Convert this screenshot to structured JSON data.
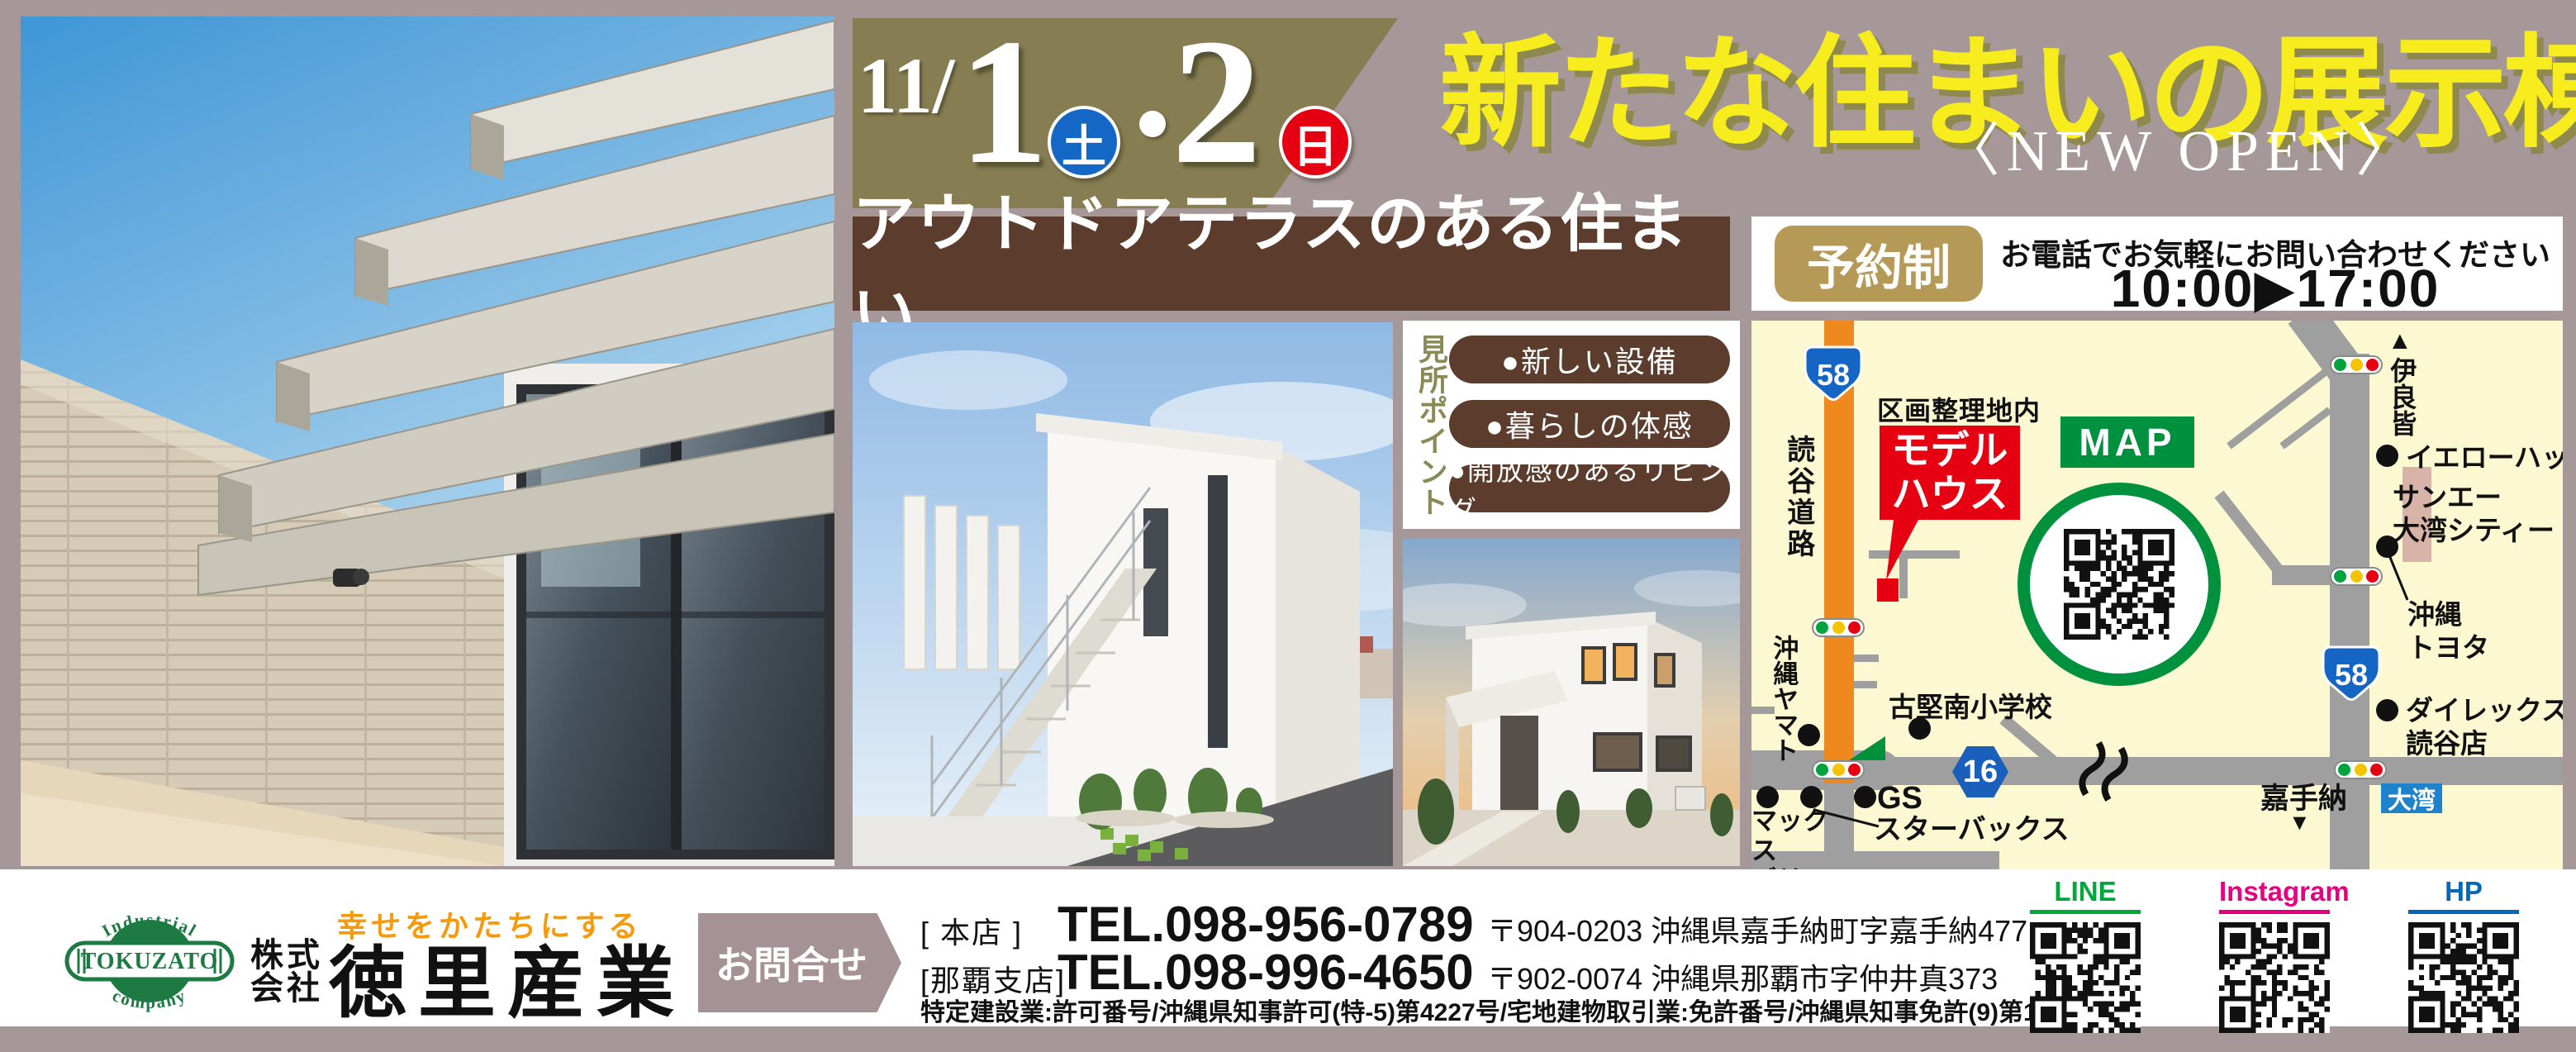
{
  "banner": {
    "month": "11",
    "slash": "/",
    "day1": "1",
    "day1_dow": "土",
    "dot": "・",
    "day2": "2",
    "day2_dow": "日"
  },
  "title": {
    "main": "新たな住まいの展示棟",
    "sub": "〈NEW OPEN〉"
  },
  "catch": {
    "text": "アウトドアテラスのある住まい"
  },
  "reserve": {
    "badge": "予約制",
    "note": "お電話でお気軽にお問い合わせください♪",
    "hours": "10:00▶17:00"
  },
  "points": {
    "heading": "見所ポイント",
    "items": [
      "●新しい設備",
      "●暮らしの体感",
      "●開放感のあるリビング"
    ]
  },
  "map": {
    "heading": "MAP",
    "route58": "58",
    "route16": "16",
    "kukaku": "区画整理地内",
    "model_line1": "モデル",
    "model_line2": "ハウス",
    "yomitan_road": "読谷道路",
    "irami_marker": "▲",
    "irami": "伊良皆",
    "yellowhat": "イエローハット",
    "sanei_line1": "サンエー",
    "sanei_line2": "大湾シティー",
    "toyota_line1": "沖縄",
    "toyota_line2": "トヨタ",
    "dairex_line1": "ダイレックス",
    "dairex_line2": "読谷店",
    "kadena": "嘉手納",
    "kadena_marker": "▼",
    "owan": "大湾",
    "school": "古堅南小学校",
    "yamato": "沖縄ヤマト",
    "maxvalu_line1": "マックス",
    "maxvalu_line2": "バリュ",
    "gs": "GS",
    "starbucks": "スターバックス"
  },
  "footer": {
    "logo": {
      "top": "Industrial",
      "center": "TOKUZATO",
      "bottom": "company"
    },
    "corp_type_line1": "株式",
    "corp_type_line2": "会社",
    "slogan": "幸せをかたちにする",
    "corp_name": "徳里産業",
    "contact": "お問合せ",
    "branches": [
      {
        "label": "[ 本店 ]",
        "tel": "TEL.098-956-0789",
        "address": "〒904-0203 沖縄県嘉手納町字嘉手納477"
      },
      {
        "label": "[那覇支店]",
        "tel": "TEL.098-996-4650",
        "address": "〒902-0074 沖縄県那覇市字仲井真373"
      }
    ],
    "license": "特定建設業:許可番号/沖縄県知事許可(特-5)第4227号/宅地建物取引業:免許番号/沖縄県知事免許(9)第1908号",
    "qr": [
      {
        "label": "LINE",
        "color": "#00a73c"
      },
      {
        "label": "Instagram",
        "color": "#e4007f"
      },
      {
        "label": "HP",
        "color": "#0068b7"
      }
    ]
  },
  "colors": {
    "background": "#a69899",
    "banner_olive": "#867d52",
    "title_yellow": "#f6ec1e",
    "brown": "#5c3c2c",
    "reserve_gold": "#b59a57",
    "map_cream": "#fbf8d2",
    "road_gray": "#9f9f9f",
    "road_orange": "#f0891d",
    "red": "#e50012",
    "green": "#00913f",
    "route_blue": "#1565c4",
    "owan_blue": "#1f83cc",
    "logo_green": "#1c7a42",
    "slogan_orange": "#f49a0b"
  }
}
